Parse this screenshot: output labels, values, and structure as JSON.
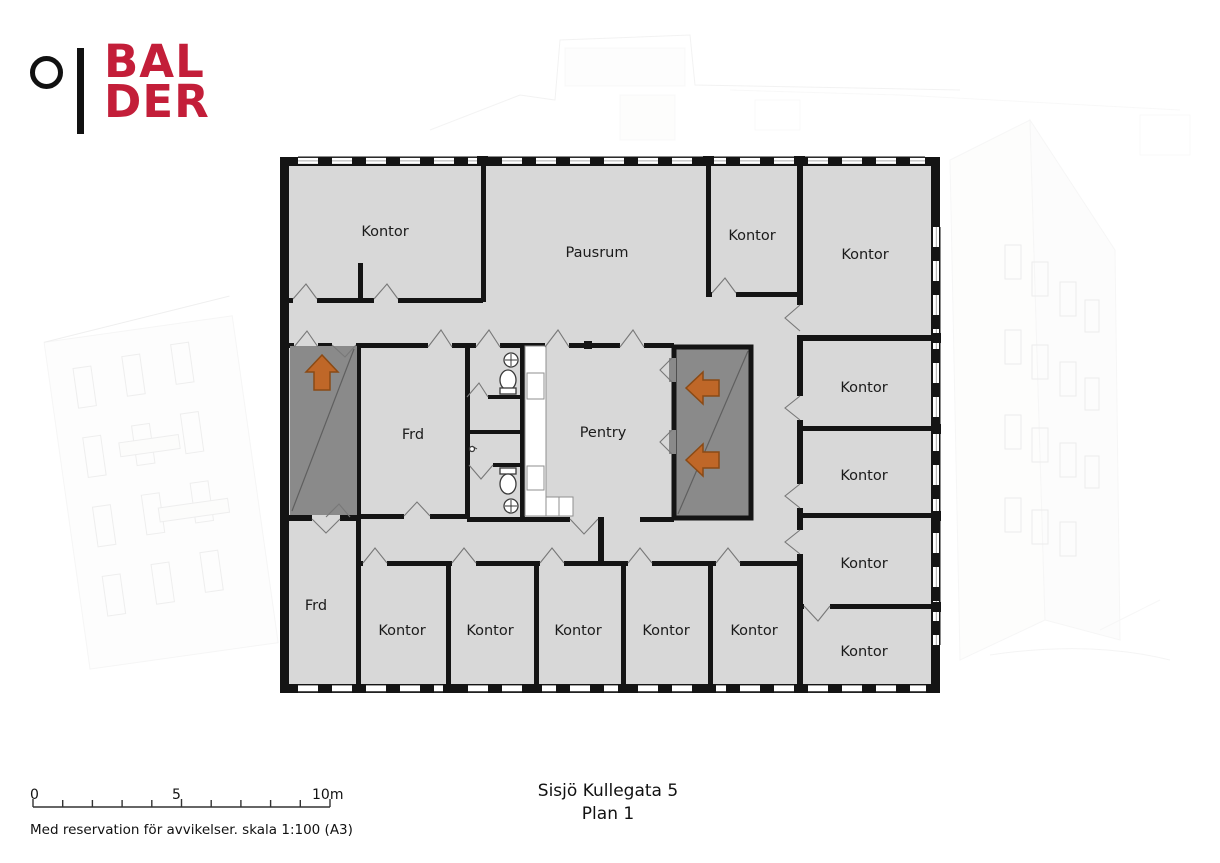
{
  "brand": {
    "logo_top": "BAL",
    "logo_bottom": "DER",
    "logo_color": "#c31e39"
  },
  "plan": {
    "title": "Sisjö Kullegata 5",
    "floor": "Plan 1",
    "rooms": [
      {
        "id": "kontor-nw",
        "label": "Kontor"
      },
      {
        "id": "pausrum",
        "label": "Pausrum"
      },
      {
        "id": "kontor-n",
        "label": "Kontor"
      },
      {
        "id": "kontor-ne",
        "label": "Kontor"
      },
      {
        "id": "kontor-e1",
        "label": "Kontor"
      },
      {
        "id": "kontor-e2",
        "label": "Kontor"
      },
      {
        "id": "kontor-e3",
        "label": "Kontor"
      },
      {
        "id": "kontor-e4",
        "label": "Kontor"
      },
      {
        "id": "frd-mid",
        "label": "Frd"
      },
      {
        "id": "pentry",
        "label": "Pentry"
      },
      {
        "id": "frd-sw",
        "label": "Frd"
      },
      {
        "id": "kontor-s1",
        "label": "Kontor"
      },
      {
        "id": "kontor-s2",
        "label": "Kontor"
      },
      {
        "id": "kontor-s3",
        "label": "Kontor"
      },
      {
        "id": "kontor-s4",
        "label": "Kontor"
      },
      {
        "id": "kontor-s5",
        "label": "Kontor"
      }
    ],
    "icons": [
      "stairs-up-arrow",
      "exit-left-arrow",
      "exit-left-arrow"
    ],
    "colors": {
      "room_fill": "#d8d8d8",
      "core_fill": "#8a8a8a",
      "wall": "#141414",
      "arrow": "#bf6728",
      "fixture": "#ffffff"
    }
  },
  "scale_bar": {
    "label_start": "0",
    "label_mid": "5",
    "label_end": "10m"
  },
  "footer_note": "Med reservation för avvikelser. skala 1:100 (A3)"
}
